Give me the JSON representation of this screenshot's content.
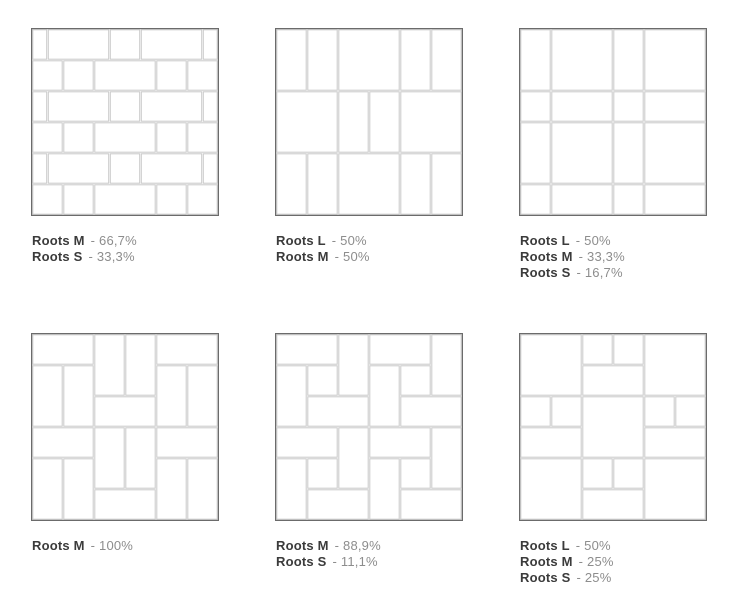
{
  "colors": {
    "background": "#ffffff",
    "tile_fill": "#ffffff",
    "grout_line": "#c9c9c9",
    "frame_border": "#6b6b6b",
    "legend_name": "#3b3b3b",
    "legend_value": "#8d8d8d"
  },
  "legend_separator": "-",
  "patterns": [
    {
      "name": "running-bond-mix",
      "grid_units": 6,
      "legend": [
        {
          "size": "Roots M",
          "value": "66,7%"
        },
        {
          "size": "Roots S",
          "value": "33,3%"
        }
      ],
      "tiles": [
        [
          0,
          0,
          0.5,
          1
        ],
        [
          0.5,
          0,
          2,
          1
        ],
        [
          2.5,
          0,
          1,
          1
        ],
        [
          3.5,
          0,
          2,
          1
        ],
        [
          5.5,
          0,
          0.5,
          1
        ],
        [
          0,
          1,
          1,
          1
        ],
        [
          1,
          1,
          1,
          1
        ],
        [
          2,
          1,
          2,
          1
        ],
        [
          4,
          1,
          1,
          1
        ],
        [
          5,
          1,
          1,
          1
        ],
        [
          0,
          2,
          0.5,
          1
        ],
        [
          0.5,
          2,
          2,
          1
        ],
        [
          2.5,
          2,
          1,
          1
        ],
        [
          3.5,
          2,
          2,
          1
        ],
        [
          5.5,
          2,
          0.5,
          1
        ],
        [
          0,
          3,
          1,
          1
        ],
        [
          1,
          3,
          1,
          1
        ],
        [
          2,
          3,
          2,
          1
        ],
        [
          4,
          3,
          1,
          1
        ],
        [
          5,
          3,
          1,
          1
        ],
        [
          0,
          4,
          0.5,
          1
        ],
        [
          0.5,
          4,
          2,
          1
        ],
        [
          2.5,
          4,
          1,
          1
        ],
        [
          3.5,
          4,
          2,
          1
        ],
        [
          5.5,
          4,
          0.5,
          1
        ],
        [
          0,
          5,
          1,
          1
        ],
        [
          1,
          5,
          1,
          1
        ],
        [
          2,
          5,
          2,
          1
        ],
        [
          4,
          5,
          1,
          1
        ],
        [
          5,
          5,
          1,
          1
        ]
      ]
    },
    {
      "name": "large-square-vertical-mix",
      "grid_units": 6,
      "legend": [
        {
          "size": "Roots L",
          "value": "50%"
        },
        {
          "size": "Roots M",
          "value": "50%"
        }
      ],
      "tiles": [
        [
          0,
          0,
          1,
          2
        ],
        [
          1,
          0,
          1,
          2
        ],
        [
          2,
          0,
          2,
          2
        ],
        [
          4,
          0,
          1,
          2
        ],
        [
          5,
          0,
          1,
          2
        ],
        [
          0,
          2,
          2,
          2
        ],
        [
          2,
          2,
          1,
          2
        ],
        [
          3,
          2,
          1,
          2
        ],
        [
          4,
          2,
          2,
          2
        ],
        [
          0,
          4,
          1,
          2
        ],
        [
          1,
          4,
          1,
          2
        ],
        [
          2,
          4,
          2,
          2
        ],
        [
          4,
          4,
          1,
          2
        ],
        [
          5,
          4,
          1,
          2
        ]
      ]
    },
    {
      "name": "modular-grid",
      "grid_units": 6,
      "legend": [
        {
          "size": "Roots L",
          "value": "50%"
        },
        {
          "size": "Roots M",
          "value": "33,3%"
        },
        {
          "size": "Roots S",
          "value": "16,7%"
        }
      ],
      "tiles": [
        [
          0,
          0,
          1,
          2
        ],
        [
          1,
          0,
          2,
          2
        ],
        [
          3,
          0,
          1,
          2
        ],
        [
          4,
          0,
          2,
          2
        ],
        [
          0,
          2,
          1,
          1
        ],
        [
          1,
          2,
          2,
          1
        ],
        [
          3,
          2,
          1,
          1
        ],
        [
          4,
          2,
          2,
          1
        ],
        [
          0,
          3,
          1,
          2
        ],
        [
          1,
          3,
          2,
          2
        ],
        [
          3,
          3,
          1,
          2
        ],
        [
          4,
          3,
          2,
          2
        ],
        [
          0,
          5,
          1,
          1
        ],
        [
          1,
          5,
          2,
          1
        ],
        [
          3,
          5,
          1,
          1
        ],
        [
          4,
          5,
          2,
          1
        ]
      ]
    },
    {
      "name": "basketweave-pinwheel",
      "grid_units": 6,
      "legend": [
        {
          "size": "Roots M",
          "value": "100%"
        }
      ],
      "tiles": [
        [
          0,
          0,
          2,
          1
        ],
        [
          2,
          0,
          1,
          2
        ],
        [
          3,
          0,
          1,
          2
        ],
        [
          4,
          0,
          2,
          1
        ],
        [
          0,
          1,
          1,
          2
        ],
        [
          1,
          1,
          1,
          2
        ],
        [
          4,
          1,
          1,
          2
        ],
        [
          5,
          1,
          1,
          2
        ],
        [
          2,
          2,
          2,
          1
        ],
        [
          0,
          3,
          2,
          1
        ],
        [
          2,
          3,
          1,
          2
        ],
        [
          3,
          3,
          1,
          2
        ],
        [
          4,
          3,
          2,
          1
        ],
        [
          0,
          4,
          1,
          2
        ],
        [
          1,
          4,
          1,
          2
        ],
        [
          4,
          4,
          1,
          2
        ],
        [
          5,
          4,
          1,
          2
        ],
        [
          2,
          5,
          2,
          1
        ]
      ]
    },
    {
      "name": "pinwheel-with-center-square",
      "grid_units": 6,
      "legend": [
        {
          "size": "Roots M",
          "value": "88,9%"
        },
        {
          "size": "Roots S",
          "value": "11,1%"
        }
      ],
      "tiles": [
        [
          0,
          0,
          2,
          1
        ],
        [
          2,
          0,
          1,
          2
        ],
        [
          0,
          1,
          1,
          2
        ],
        [
          1,
          1,
          1,
          1
        ],
        [
          1,
          2,
          2,
          1
        ],
        [
          3,
          0,
          2,
          1
        ],
        [
          5,
          0,
          1,
          2
        ],
        [
          3,
          1,
          1,
          2
        ],
        [
          4,
          1,
          1,
          1
        ],
        [
          4,
          2,
          2,
          1
        ],
        [
          0,
          3,
          2,
          1
        ],
        [
          2,
          3,
          1,
          2
        ],
        [
          0,
          4,
          1,
          2
        ],
        [
          1,
          4,
          1,
          1
        ],
        [
          1,
          5,
          2,
          1
        ],
        [
          3,
          3,
          2,
          1
        ],
        [
          5,
          3,
          1,
          2
        ],
        [
          3,
          4,
          1,
          2
        ],
        [
          4,
          4,
          1,
          1
        ],
        [
          4,
          5,
          2,
          1
        ]
      ]
    },
    {
      "name": "cross-modular",
      "grid_units": 6,
      "legend": [
        {
          "size": "Roots L",
          "value": "50%"
        },
        {
          "size": "Roots M",
          "value": "25%"
        },
        {
          "size": "Roots S",
          "value": "25%"
        }
      ],
      "tiles": [
        [
          0,
          0,
          2,
          2
        ],
        [
          2,
          0,
          1,
          1
        ],
        [
          3,
          0,
          1,
          1
        ],
        [
          4,
          0,
          2,
          2
        ],
        [
          2,
          1,
          2,
          1
        ],
        [
          0,
          2,
          1,
          1
        ],
        [
          1,
          2,
          1,
          1
        ],
        [
          2,
          2,
          2,
          2
        ],
        [
          4,
          2,
          1,
          1
        ],
        [
          5,
          2,
          1,
          1
        ],
        [
          0,
          3,
          2,
          1
        ],
        [
          4,
          3,
          2,
          1
        ],
        [
          0,
          4,
          2,
          2
        ],
        [
          2,
          4,
          1,
          1
        ],
        [
          3,
          4,
          1,
          1
        ],
        [
          4,
          4,
          2,
          2
        ],
        [
          2,
          5,
          2,
          1
        ]
      ]
    }
  ]
}
